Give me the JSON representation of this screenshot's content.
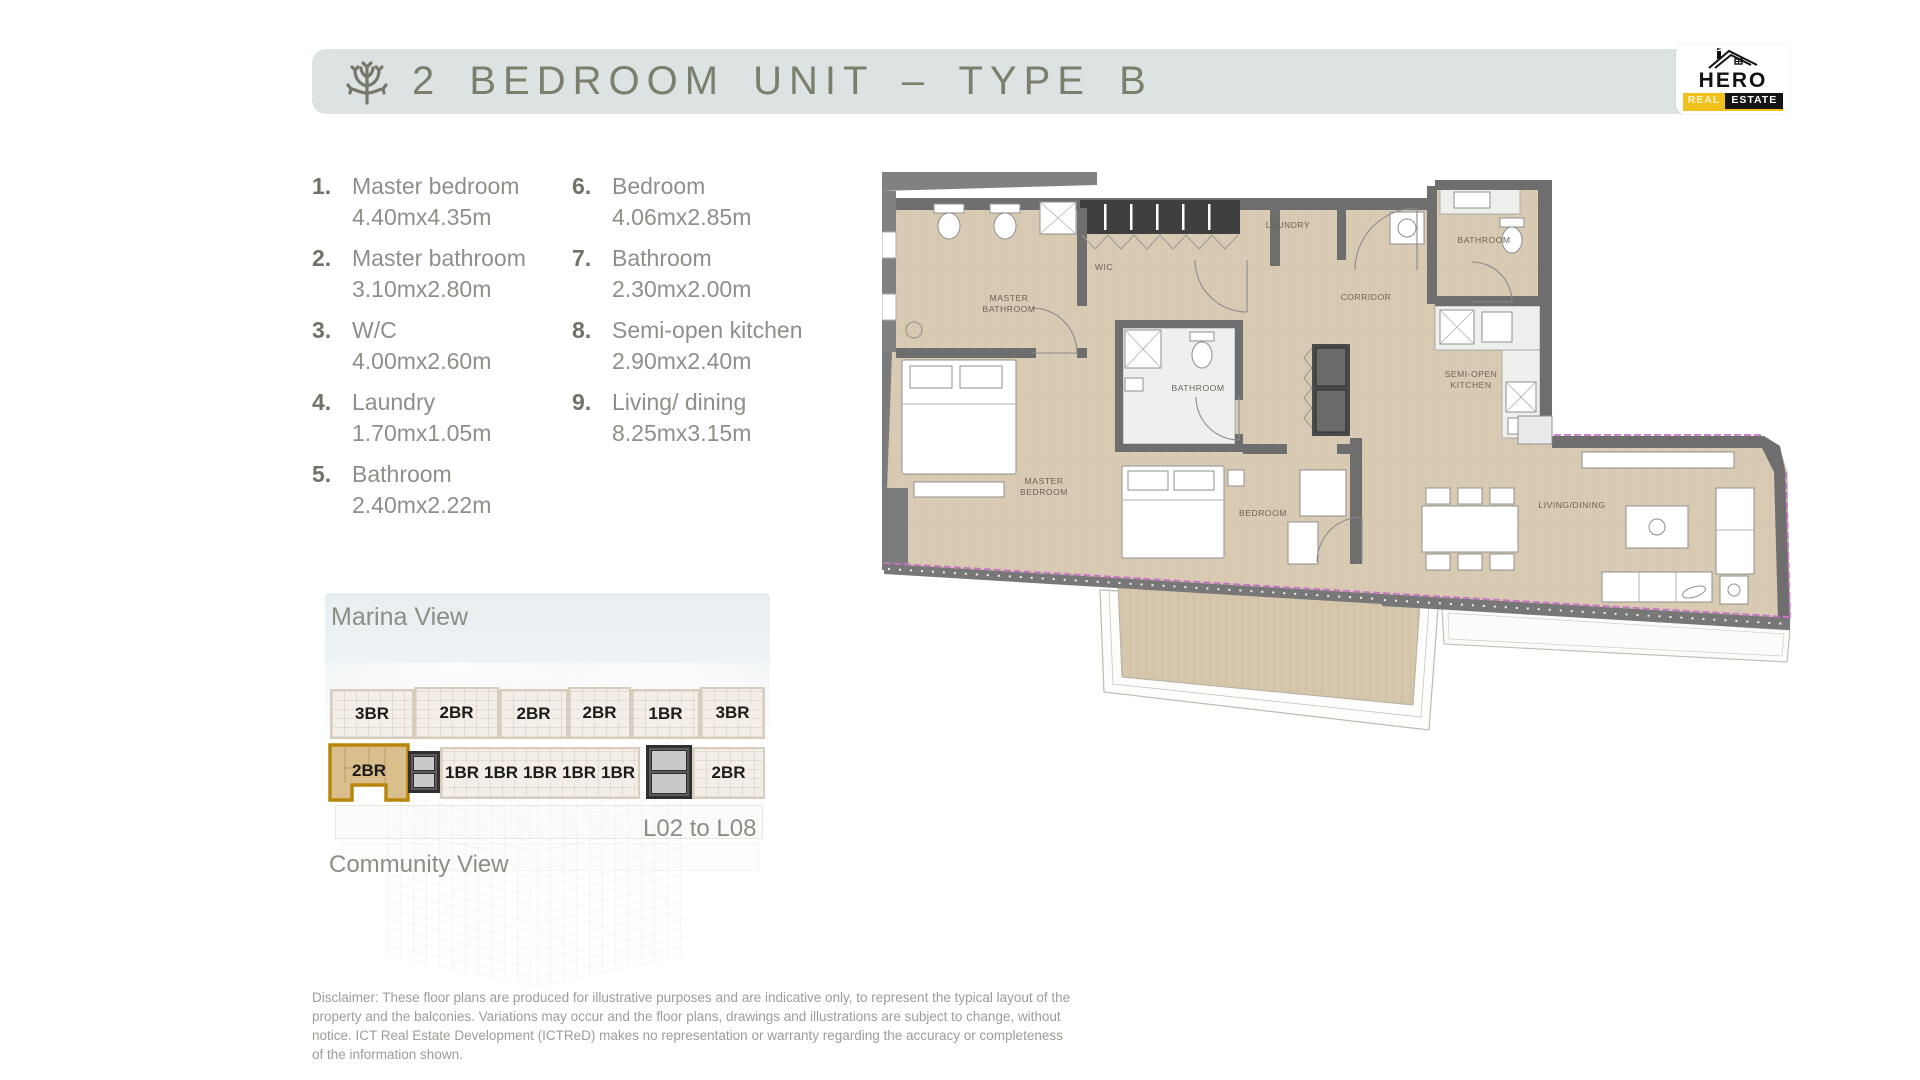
{
  "header": {
    "title": "2 BEDROOM UNIT – TYPE B"
  },
  "logo": {
    "name": "HERO",
    "real": "REAL",
    "estate": "ESTATE"
  },
  "room_list": {
    "items": [
      {
        "num": "1.",
        "name": "Master bedroom",
        "dims": "4.40mx4.35m"
      },
      {
        "num": "2.",
        "name": "Master bathroom",
        "dims": "3.10mx2.80m"
      },
      {
        "num": "3.",
        "name": "W/C",
        "dims": "4.00mx2.60m"
      },
      {
        "num": "4.",
        "name": "Laundry",
        "dims": "1.70mx1.05m"
      },
      {
        "num": "5.",
        "name": "Bathroom",
        "dims": "2.40mx2.22m"
      },
      {
        "num": "6.",
        "name": "Bedroom",
        "dims": "4.06mx2.85m"
      },
      {
        "num": "7.",
        "name": "Bathroom",
        "dims": "2.30mx2.00m"
      },
      {
        "num": "8.",
        "name": "Semi-open kitchen",
        "dims": "2.90mx2.40m"
      },
      {
        "num": "9.",
        "name": "Living/ dining",
        "dims": "8.25mx3.15m"
      }
    ]
  },
  "floorplan": {
    "labels": {
      "master_bathroom_l1": "MASTER",
      "master_bathroom_l2": "BATHROOM",
      "wic": "WIC",
      "laundry": "LAUNDRY",
      "corridor": "CORRIDOR",
      "bathroom_small": "BATHROOM",
      "bathroom_top": "BATHROOM",
      "kitchen_l1": "SEMI-OPEN",
      "kitchen_l2": "KITCHEN",
      "master_bedroom_l1": "MASTER",
      "master_bedroom_l2": "BEDROOM",
      "bedroom": "BEDROOM",
      "living_dining": "LIVING/DINING"
    }
  },
  "building": {
    "marina_view": "Marina View",
    "community_view": "Community View",
    "levels": "L02 to L08",
    "row1": [
      "3BR",
      "2BR",
      "2BR",
      "2BR",
      "1BR",
      "3BR"
    ],
    "row2": {
      "highlighted": "2BR",
      "mids": [
        "1BR",
        "1BR",
        "1BR",
        "1BR",
        "1BR"
      ],
      "right": "2BR"
    }
  },
  "disclaimer": "Disclaimer: These floor plans are produced for illustrative purposes and are indicative only, to represent the typical layout of the property and the balconies. Variations may occur and the floor plans, drawings and illustrations are subject to change, without notice. ICT Real Estate Development (ICTReD) makes no representation or warranty regarding the accuracy or completeness of the information shown.",
  "colors": {
    "header_bg": "#dde3e2",
    "title": "#7c7f6c",
    "floor": "#d9cbb3",
    "wall": "#6e6e6e",
    "highlight_gold": "#b8860b",
    "highlight_fill": "#d9bf8c",
    "magenta_accent": "#c873c8",
    "logo_yellow": "#f2c21c"
  }
}
